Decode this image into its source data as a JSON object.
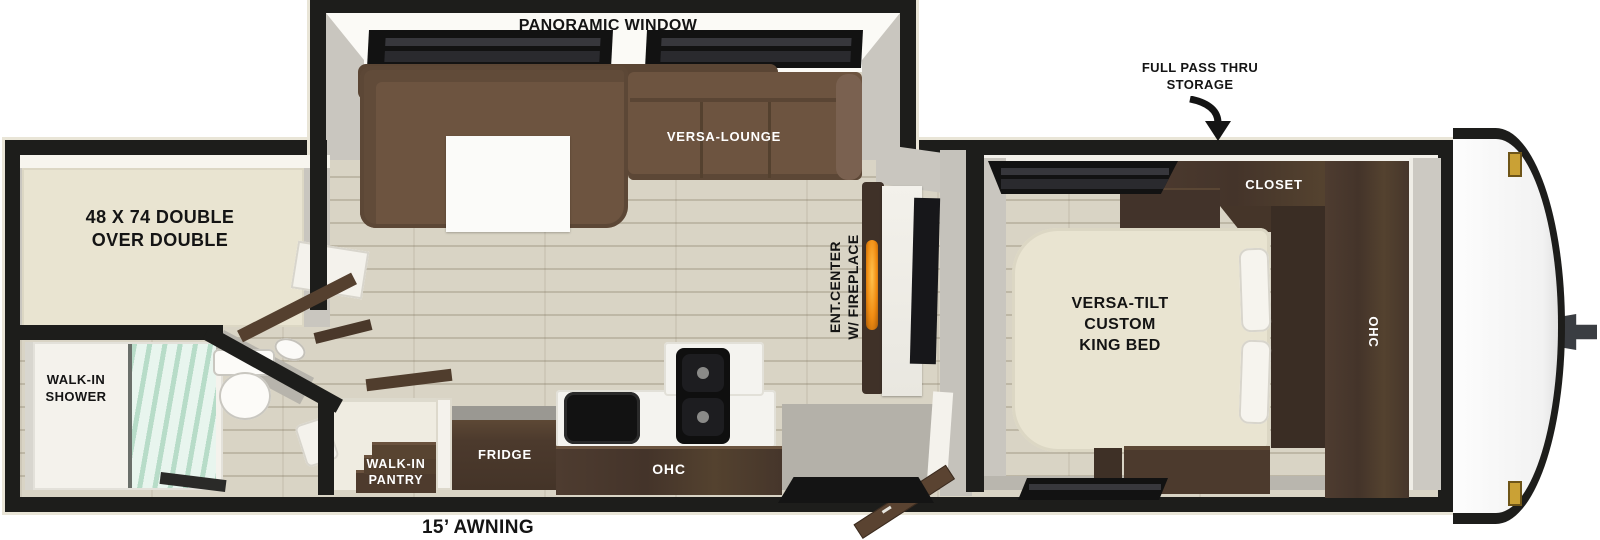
{
  "plan": {
    "slideout": {
      "window_label": "PANORAMIC WINDOW",
      "lounge_label": "VERSA-LOUNGE"
    },
    "exterior": {
      "storage_label_line1": "FULL PASS THRU",
      "storage_label_line2": "STORAGE",
      "awning_label": "15’ AWNING"
    },
    "bunk_room": {
      "bed_label_line1": "48 X 74 DOUBLE",
      "bed_label_line2": "OVER DOUBLE"
    },
    "bathroom": {
      "shower_label_line1": "WALK-IN",
      "shower_label_line2": "SHOWER"
    },
    "pantry": {
      "label_line1": "WALK-IN",
      "label_line2": "PANTRY"
    },
    "kitchen": {
      "fridge_label": "FRIDGE",
      "ohc_label": "OHC"
    },
    "living": {
      "ent_center_label_line1": "ENT.CENTER",
      "ent_center_label_line2": "W/ FIREPLACE"
    },
    "bedroom": {
      "closet_label": "CLOSET",
      "bed_label_line1": "VERSA-TILT",
      "bed_label_line2": "CUSTOM",
      "bed_label_line3": "KING BED",
      "ohc_label": "OHC"
    }
  },
  "colors": {
    "wall_black": "#1d1d1b",
    "exterior_trim": "#e9e5d7",
    "floor_wood": "#d9d4c5",
    "sofa_brown": "#6d5440",
    "cabinet_brown": "#4e3c30",
    "bed_cream": "#e9e4d1",
    "interior_gray": "#c9c6bf",
    "fireplace_flame": "#f7a21d",
    "shower_glass": "#bfdccb",
    "marker_gold": "#caa135"
  }
}
